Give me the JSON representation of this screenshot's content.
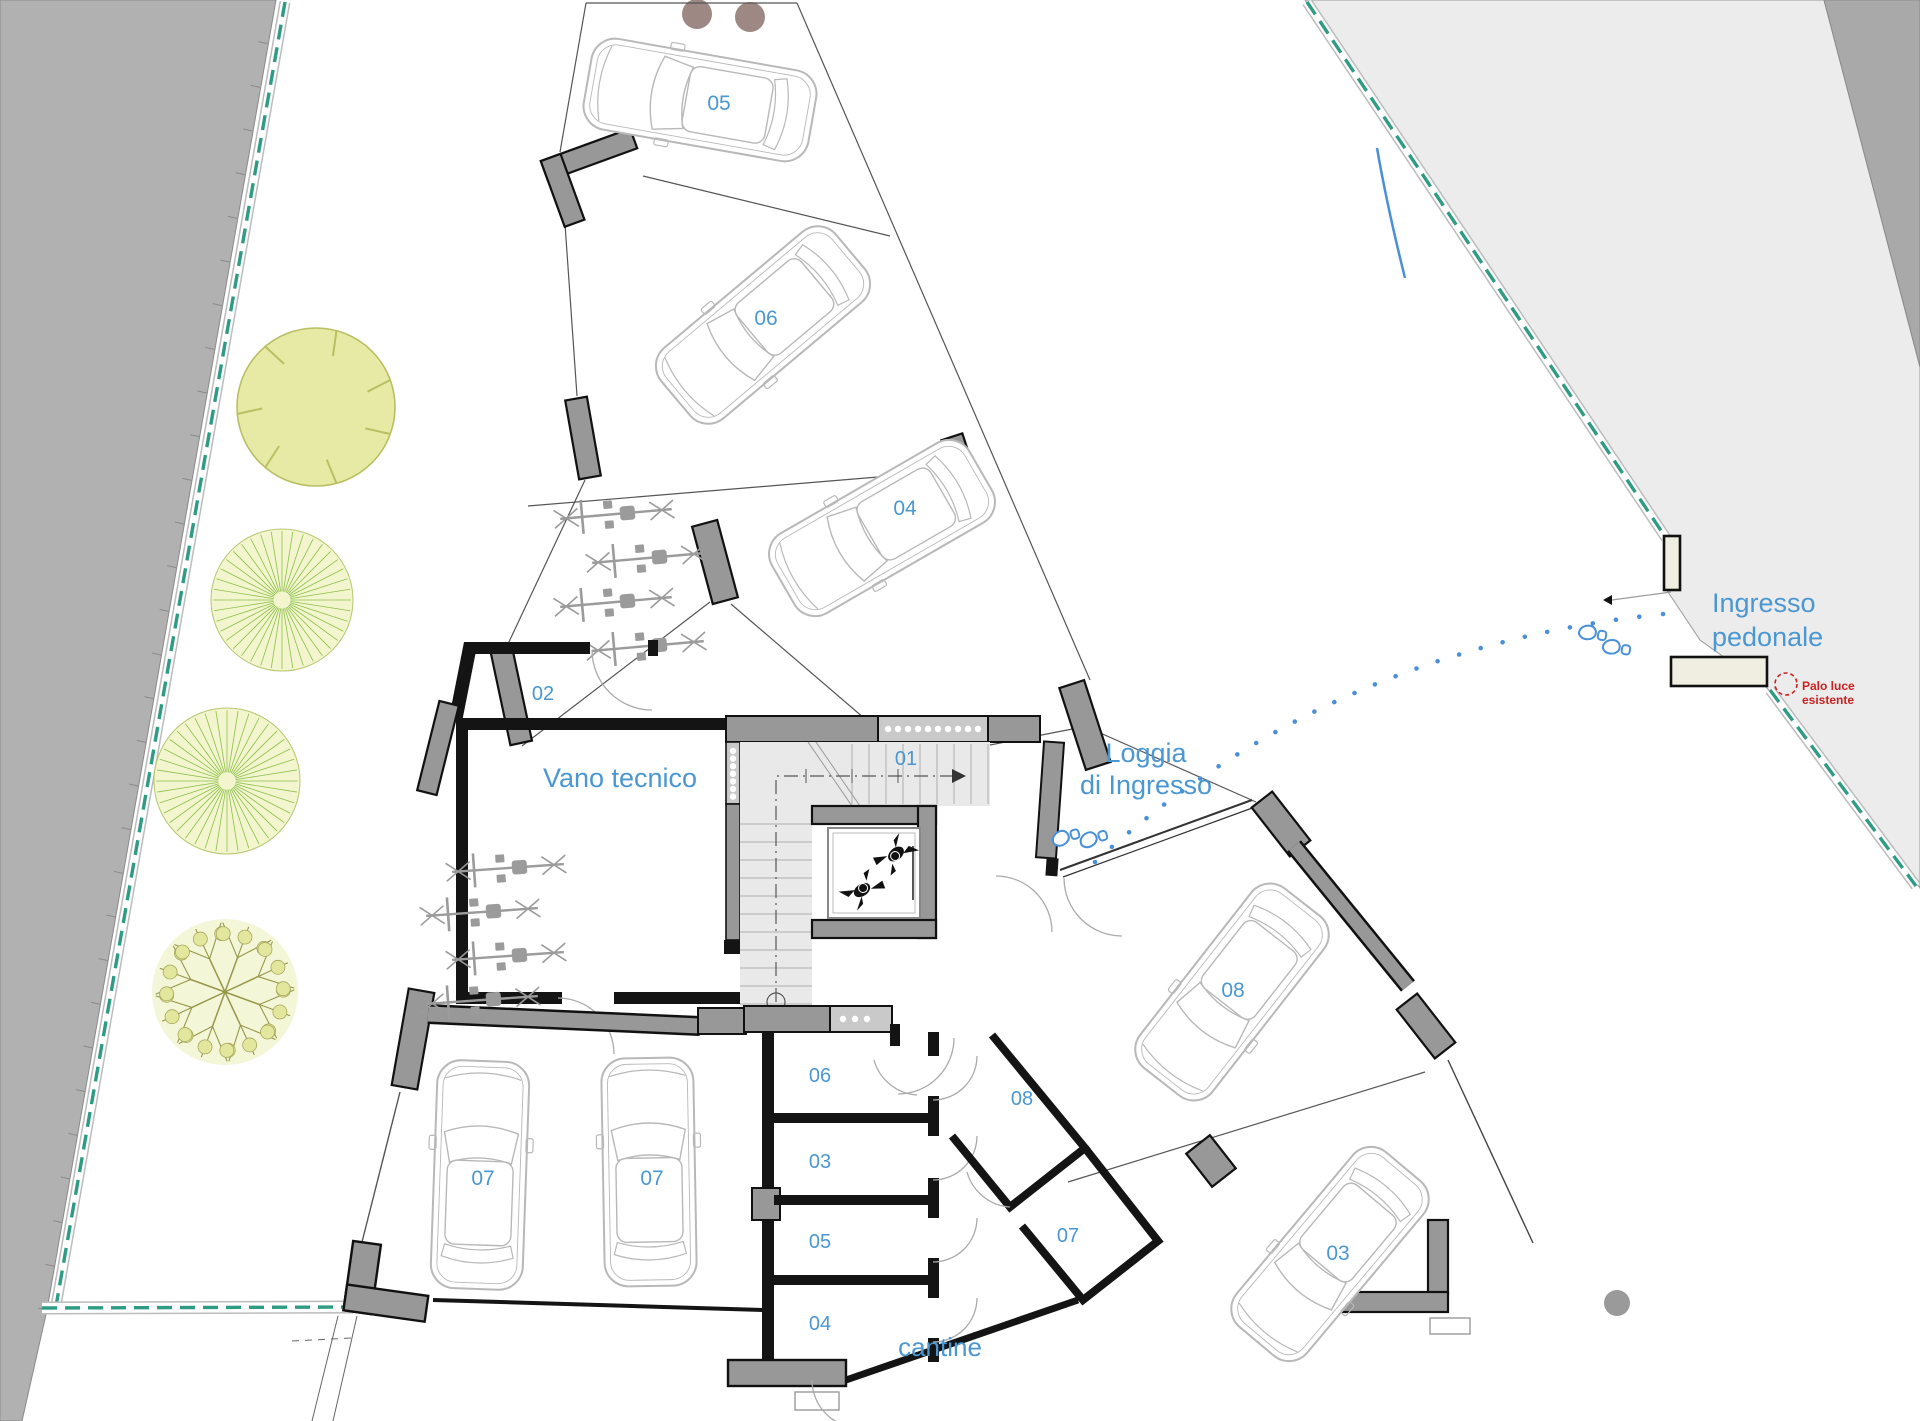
{
  "plan": {
    "parking_labels": {
      "p05": "05",
      "p06": "06",
      "p04": "04",
      "p07a": "07",
      "p07b": "07",
      "p08": "08",
      "p03": "03"
    },
    "rooms": {
      "r02": "02",
      "r01": "01",
      "vano": "Vano tecnico"
    },
    "cantine": {
      "c06": "06",
      "c03": "03",
      "c05": "05",
      "c04": "04",
      "c08": "08",
      "c07": "07",
      "area": "cantine"
    },
    "annotations": {
      "loggia1": "Loggia",
      "loggia2": "di Ingresso",
      "ingresso1": "Ingresso",
      "ingresso2": "pedonale",
      "palo1": "Palo luce",
      "palo2": "esistente"
    },
    "colors": {
      "label_blue": "#4a97d2",
      "alert_red": "#cc2020",
      "fence_teal": "#2e9c84",
      "road_gray": "#b1b1b1",
      "walkway_light": "#ececec",
      "walkway_dark": "#a9a9a9",
      "wall_gray": "#989898",
      "wall_black": "#141414",
      "tree_green": "#8cc04a",
      "car_outline": "#b8b8b8"
    }
  }
}
